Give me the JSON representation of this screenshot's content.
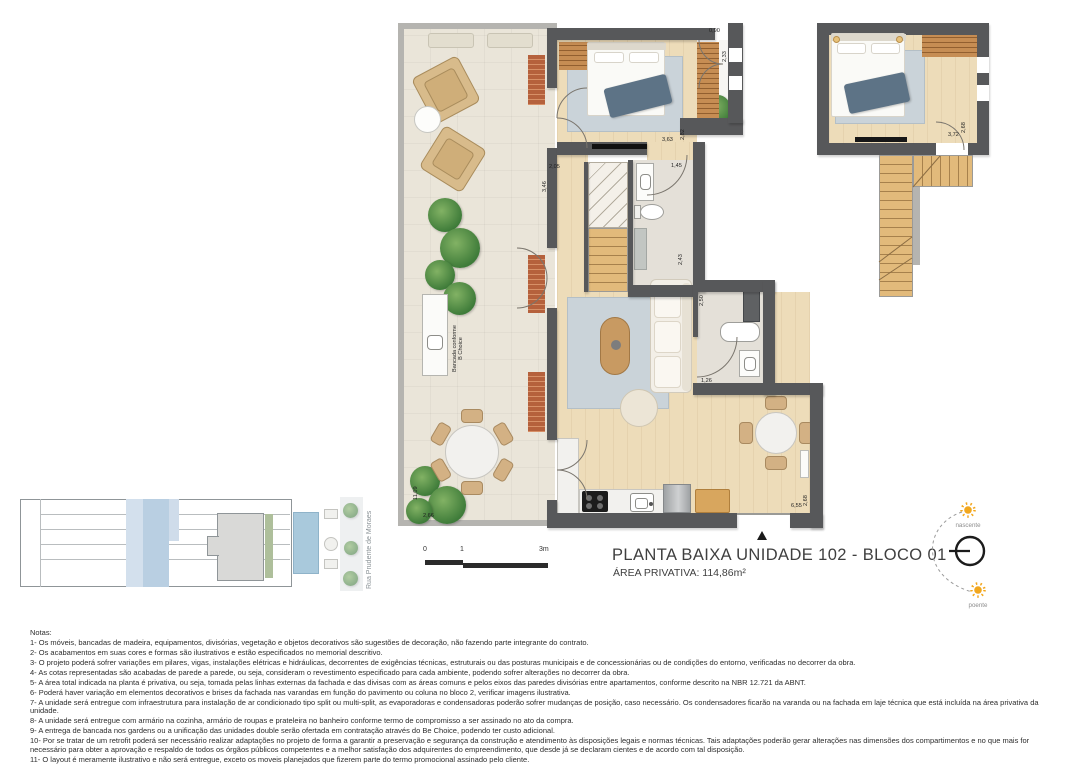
{
  "title_block": {
    "title": "PLANTA BAIXA UNIDADE 102 - BLOCO 01",
    "area_label": "ÁREA PRIVATIVA:  114,86m²"
  },
  "scale_bar": {
    "zero": "0",
    "one": "1",
    "three": "3m"
  },
  "compass": {
    "east_label": "nascente",
    "west_label": "poente"
  },
  "site_plan": {
    "street_label": "Rua Prudente de Moraes"
  },
  "plan_labels": {
    "bancada_line1": "Bancada conforme",
    "bancada_line2": "B Choice"
  },
  "dimensions": [
    {
      "text": "0,90",
      "x": 709,
      "y": 28,
      "rot": 0
    },
    {
      "text": "2,33",
      "x": 722,
      "y": 62,
      "rot": 90
    },
    {
      "text": "3,63",
      "x": 662,
      "y": 137,
      "rot": 0
    },
    {
      "text": "2,82",
      "x": 680,
      "y": 140,
      "rot": 90
    },
    {
      "text": "2,05",
      "x": 549,
      "y": 164,
      "rot": 0
    },
    {
      "text": "3,46",
      "x": 542,
      "y": 192,
      "rot": 90
    },
    {
      "text": "1,45",
      "x": 671,
      "y": 163,
      "rot": 0
    },
    {
      "text": "2,43",
      "x": 678,
      "y": 265,
      "rot": 90
    },
    {
      "text": "2,50",
      "x": 699,
      "y": 306,
      "rot": 90
    },
    {
      "text": "1,26",
      "x": 701,
      "y": 378,
      "rot": 0
    },
    {
      "text": "11,09",
      "x": 413,
      "y": 500,
      "rot": 90
    },
    {
      "text": "2,66",
      "x": 423,
      "y": 513,
      "rot": 0
    },
    {
      "text": "2,68",
      "x": 803,
      "y": 506,
      "rot": 90
    },
    {
      "text": "6,55",
      "x": 791,
      "y": 503,
      "rot": 0
    },
    {
      "text": "3,72",
      "x": 948,
      "y": 132,
      "rot": 0
    },
    {
      "text": "2,68",
      "x": 961,
      "y": 133,
      "rot": 90
    }
  ],
  "notes": {
    "heading": "Notas:",
    "items": [
      "1- Os móveis, bancadas de madeira, equipamentos, divisórias, vegetação e objetos decorativos são sugestões de decoração, não fazendo parte integrante do contrato.",
      "2- Os acabamentos em suas cores e formas são ilustrativos e estão especificados no memorial descritivo.",
      "3- O projeto poderá sofrer variações em pilares, vigas, instalações elétricas e hidráulicas, decorrentes de exigências técnicas, estruturais ou das posturas municipais e de concessionárias ou de condições do entorno, verificadas no decorrer da obra.",
      "4- As cotas representadas são acabadas de parede a parede, ou seja, consideram o revestimento especificado para cada ambiente, podendo sofrer alterações no decorrer da obra.",
      "5- A área total indicada na planta é privativa, ou seja, tomada pelas linhas externas da fachada e das divisas com as áreas comuns e pelos eixos das paredes divisórias entre apartamentos, conforme descrito na NBR 12.721 da ABNT.",
      "6- Poderá haver variação em elementos decorativos e brises da fachada nas varandas em função do pavimento ou coluna no bloco 2, verificar imagens ilustrativa.",
      "7- A unidade será entregue com infraestrutura para instalação de ar condicionado tipo split ou multi-split, as evaporadoras e condensadoras poderão sofrer mudanças de posição, caso necessário. Os condensadores ficarão na varanda ou na fachada em laje técnica que está incluída na área privativa da unidade.",
      "8- A unidade será entregue com armário na cozinha, armário de roupas e prateleira no banheiro conforme termo de compromisso a ser assinado no ato da compra.",
      "9- A entrega de bancada nos gardens ou a unificação das unidades double serão ofertada em contratação através do Be Choice, podendo ter custo adicional.",
      "10- Por se tratar de um retrofit poderá ser necessário realizar adaptações no projeto de forma a garantir a preservação e segurança da construção e atendimento às disposições legais e normas técnicas. Tais adaptações poderão gerar alterações nas dimensões dos compartimentos e no que mais for necessário para obter a aprovação e respaldo de todos os órgãos públicos competentes e a melhor satisfação dos adquirentes do empreendimento, que desde já se declaram cientes e de acordo com tal disposição.",
      "11- O layout é meramente ilustrativo e não será entregue, exceto os moveis planejados que fizerem parte do termo promocional assinado pelo cliente."
    ]
  }
}
